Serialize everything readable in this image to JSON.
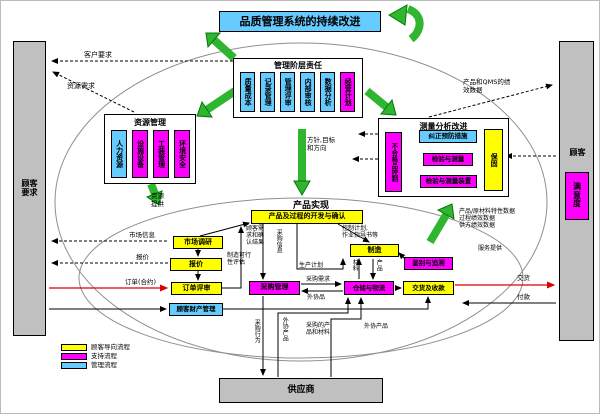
{
  "title": "品质管理系统的持续改进",
  "left_bar": "顾客\n要求",
  "right_bar": {
    "label": "顾客",
    "satisfaction": "满\n意\n度"
  },
  "management": {
    "title": "管理阶层责任",
    "items": [
      "质量成本",
      "记录管理",
      "管理评审",
      "内部审核",
      "数据分析",
      "经营计划"
    ]
  },
  "resource": {
    "title": "资源管理",
    "items": [
      "人力资源",
      "设施设备",
      "工装管理",
      "环境安全"
    ]
  },
  "measurement": {
    "title": "测量分析改进",
    "nonconforming": "不合格品控制",
    "corrective": "纠正预防措施",
    "inspection": "检验与测量",
    "devices": "检验与测量装置",
    "warranty": "保固"
  },
  "realization": {
    "title": "产品实现",
    "development": "产品及过程的开发与确认",
    "market_research": "市场调研",
    "quotation": "报价",
    "order_review": "订单评审",
    "customer_property": "顾客财产管理",
    "purchasing": "采购管理",
    "warehouse": "仓储与物流",
    "delivery": "交货及收款",
    "manufacturing": "制造",
    "traceability": "鉴别与追溯"
  },
  "supplier": "供应商",
  "labels": {
    "customer_demand": "客户要求",
    "resource_demand": "资源需求",
    "qms_performance": "产品和QMS的绩\n效数据",
    "policy": "方针,目标\n和方向",
    "resource_supply": "资源\n提供",
    "market_info": "市场信息",
    "quote": "报价",
    "order_contract": "订单(合约)",
    "delivery_out": "交货",
    "payment": "付款",
    "customer_confirm": "顾客需\n求和确\n认结果",
    "feasibility": "制造可行\n性评估",
    "purchase_info": "采购信息",
    "production_plan": "生产计划",
    "control_plan": "控制计划,\n作业指导书等",
    "material": "材料",
    "product": "产品",
    "purchase_demand": "采购需求",
    "outsourced_item": "外协品",
    "purchase_action": "采购行为",
    "outsourced_product_v": "外协产品",
    "purchased_materials": "采购的产\n品和材料",
    "outsourced_product_h": "外协产品",
    "perf_block": "产品/原材料特性数据\n过程绩效数据\n供方绩效数据",
    "service_supply": "服务提供"
  },
  "legend": [
    {
      "label": "顾客导向流程",
      "color": "#ffff00"
    },
    {
      "label": "支持流程",
      "color": "#ff00ff"
    },
    {
      "label": "管理流程",
      "color": "#66ccff"
    }
  ],
  "colors": {
    "cyan": "#66ccff",
    "magenta": "#ff00ff",
    "yellow": "#ffff00",
    "gray": "#c0c0c0",
    "green": "#2fb52f",
    "red_arrow": "#dd0000"
  }
}
